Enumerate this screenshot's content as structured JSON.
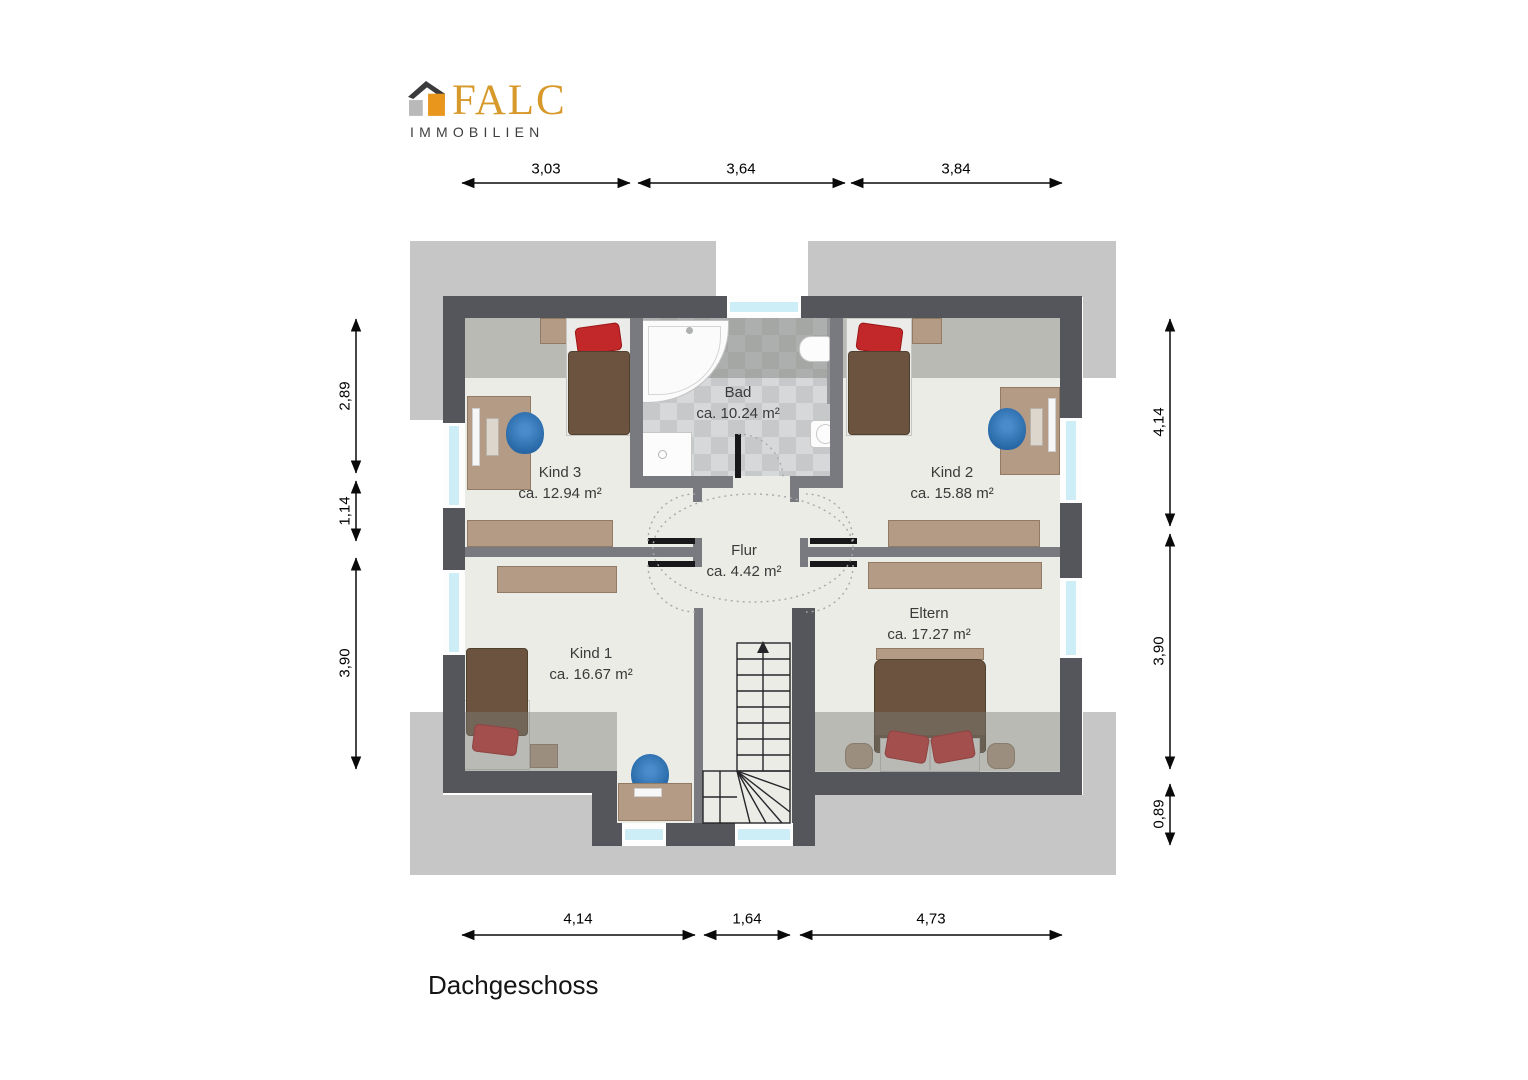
{
  "logo": {
    "brand": "FALC",
    "tagline": "IMMOBILIEN"
  },
  "title": "Dachgeschoss",
  "rooms": {
    "bad": {
      "name": "Bad",
      "area": "ca. 10.24 m²"
    },
    "kind3": {
      "name": "Kind 3",
      "area": "ca. 12.94 m²"
    },
    "kind2": {
      "name": "Kind 2",
      "area": "ca. 15.88 m²"
    },
    "flur": {
      "name": "Flur",
      "area": "ca. 4.42 m²"
    },
    "kind1": {
      "name": "Kind 1",
      "area": "ca. 16.67 m²"
    },
    "eltern": {
      "name": "Eltern",
      "area": "ca. 17.27 m²"
    }
  },
  "dimensions": {
    "top": [
      "3,03",
      "3,64",
      "3,84"
    ],
    "bottom": [
      "4,14",
      "1,64",
      "4,73"
    ],
    "left": [
      "2,89",
      "1,14",
      "3,90"
    ],
    "right": [
      "4,14",
      "3,90",
      "0,89"
    ]
  },
  "colors": {
    "exterior": "#c6c6c6",
    "wall_dark": "#55565b",
    "wall_medium": "#797a7f",
    "floor": "#ebece6",
    "tile_light": "#d6d8da",
    "tile_dark": "#c6c8ca",
    "wood": "#b49b86",
    "blanket": "#6b533f",
    "pillow": "#c2282a",
    "chair": "#2e6fae",
    "glass": "#cdeef6",
    "brand_gold": "#d6992a"
  }
}
